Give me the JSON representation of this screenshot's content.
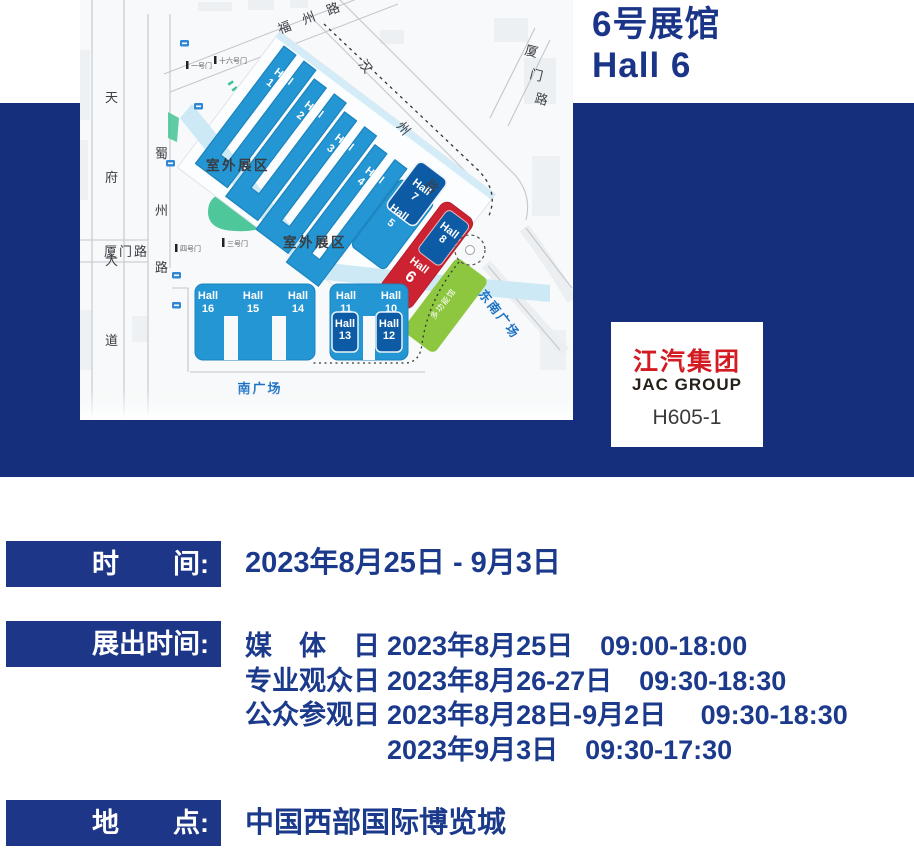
{
  "header": {
    "title_cn": "6号展馆",
    "title_en": "Hall 6"
  },
  "logo_card": {
    "brand_cn": "江汽集团",
    "brand_en": "JAC GROUP",
    "booth": "H605-1"
  },
  "info_rows": {
    "time": {
      "label": "时　　间:",
      "value": "2023年8月25日 - 9月3日"
    },
    "schedule": {
      "label": "展出时间:",
      "lines": [
        {
          "day": "媒　体　日",
          "detail": "2023年8月25日　09:00-18:00"
        },
        {
          "day": "专业观众日",
          "detail": "2023年8月26-27日　09:30-18:30"
        },
        {
          "day": "公众参观日",
          "detail": "2023年8月28日-9月2日　 09:30-18:30"
        },
        {
          "day": "",
          "detail": "2023年9月3日　09:30-17:30"
        }
      ]
    },
    "location": {
      "label": "地　　点:",
      "value": "中国西部国际博览城"
    }
  },
  "map": {
    "roads": {
      "tianfu": {
        "c1": "天",
        "c2": "府",
        "c3": "大",
        "c4": "道"
      },
      "shuzhou": {
        "c1": "蜀",
        "c2": "州",
        "c3": "路"
      },
      "xiamen_left": "厦门路",
      "fuzhou": "福州路",
      "hanzhou": {
        "c1": "汉",
        "c2": "州",
        "c3": "路"
      },
      "xiamen_right": {
        "c1": "厦",
        "c2": "门",
        "c3": "路"
      }
    },
    "areas": {
      "outdoor1": "室外展区",
      "outdoor2": "室外展区",
      "south_plaza": "南广场",
      "southeast_plaza": "东南广场",
      "multi_hall": "多功能馆"
    },
    "gates": {
      "g1": "一号门",
      "g16": "十六号门",
      "g3": "三号门",
      "g4": "四号门"
    },
    "halls": {
      "h1": {
        "name": "Hall",
        "num": "1"
      },
      "h2": {
        "name": "Hall",
        "num": "2"
      },
      "h3": {
        "name": "Hall",
        "num": "3"
      },
      "h4": {
        "name": "Hall",
        "num": "4"
      },
      "h5": {
        "name": "Hall",
        "num": "5"
      },
      "h6": {
        "name": "Hall",
        "num": "6"
      },
      "h7": {
        "name": "Hall",
        "num": "7"
      },
      "h8": {
        "name": "Hall",
        "num": "8"
      },
      "h10": {
        "name": "Hall",
        "num": "10"
      },
      "h11": {
        "name": "Hall",
        "num": "11"
      },
      "h12": {
        "name": "Hall",
        "num": "12"
      },
      "h13": {
        "name": "Hall",
        "num": "13"
      },
      "h14": {
        "name": "Hall",
        "num": "14"
      },
      "h15": {
        "name": "Hall",
        "num": "15"
      },
      "h16": {
        "name": "Hall",
        "num": "16"
      }
    }
  },
  "colors": {
    "band_navy": "#162f7c",
    "label_box_navy": "#1d3687",
    "text_navy": "#1c3a8c",
    "hall_blue": "#2496d3",
    "hall_dark_blue": "#0d5ba4",
    "hall6_red": "#cc2231",
    "multi_hall_green": "#8dc63f",
    "water_blue": "#cde9f6",
    "plaza_text_blue": "#1e72c5",
    "logo_red": "#d31b22"
  }
}
